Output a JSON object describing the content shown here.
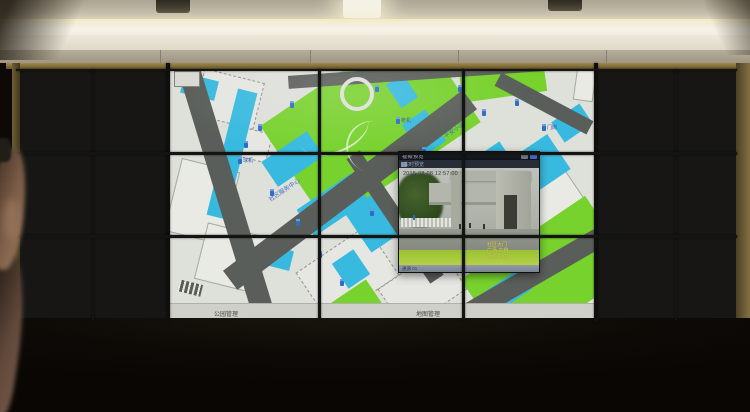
{
  "colors": {
    "map_lawn_green": "#7cdc2f",
    "map_building_cyan": "#39c3eb",
    "map_road_grey": "#5d625e",
    "marker_blue": "#2b72d0",
    "osd_yellow": "#dde437",
    "cove_light": "#fff4cf",
    "frame_gold": "#8a7545"
  },
  "wall": {
    "left_tiles": [
      {
        "scene": "lawn-building",
        "ts": "08-08 12:57",
        "ts_pos": "top"
      },
      {
        "scene": "trees-dense"
      },
      {
        "scene": "trees-dense",
        "ts": "08-08 12:57",
        "ts_pos": "top"
      },
      {
        "scene": "blue-roof"
      },
      {
        "scene": "courtyard"
      },
      {
        "scene": "tree-closeup"
      },
      {
        "scene": "dark-garage"
      },
      {
        "scene": "alley",
        "ts": "08-08 12:57"
      },
      {
        "scene": "garage-car"
      },
      {
        "scene": "alley"
      },
      {
        "scene": "dark-garage",
        "ts": "08-08 12:57"
      },
      {
        "scene": "gate-entry"
      }
    ],
    "right_tiles": [
      {
        "scene": "green-road",
        "ts": "2015-08-08 12:57"
      },
      {
        "scene": "street-dark"
      },
      {
        "scene": "parking-lot"
      },
      {
        "scene": "parking-lot",
        "ts": "08-08 12:57"
      },
      {
        "scene": "street-cars",
        "ts": "08-08 12:57",
        "ts_pos": "top"
      },
      {
        "scene": "street-cars"
      },
      {
        "scene": "cars-row",
        "ts": "08-08 12:57"
      },
      {
        "scene": "tree-closeup"
      },
      {
        "scene": "stairs",
        "ts": "08-08 12:57",
        "ts_pos": "top"
      },
      {
        "scene": "stairs-dark",
        "ts": "08-08 12:57"
      },
      {
        "scene": "alley-light"
      },
      {
        "scene": "courtyard"
      }
    ]
  },
  "map": {
    "toolbar_buttons": [
      {
        "name": "layers",
        "icon": "▦"
      },
      {
        "name": "split-view",
        "icon": "◨"
      },
      {
        "name": "locate",
        "icon": "⌖"
      },
      {
        "name": "measure",
        "icon": "▬"
      },
      {
        "name": "windows",
        "icon": "◫"
      },
      {
        "name": "refresh",
        "icon": "⟲"
      }
    ],
    "pan_control_icon": "✛",
    "status_left": "公园管理",
    "status_right": "地图管理",
    "labels": [
      {
        "x": 96,
        "y": 116,
        "t": "社区服务中心"
      },
      {
        "x": 272,
        "y": 56,
        "t": "平安小区"
      },
      {
        "x": 292,
        "y": 152,
        "t": "文化广场"
      }
    ],
    "markers": [
      {
        "x": 120,
        "y": 32
      },
      {
        "x": 88,
        "y": 55
      },
      {
        "x": 74,
        "y": 72
      },
      {
        "x": 68,
        "y": 88,
        "label": "球机"
      },
      {
        "x": 100,
        "y": 120
      },
      {
        "x": 126,
        "y": 150
      },
      {
        "x": 148,
        "y": 182
      },
      {
        "x": 170,
        "y": 210
      },
      {
        "x": 205,
        "y": 16
      },
      {
        "x": 226,
        "y": 48,
        "label": "枪机"
      },
      {
        "x": 252,
        "y": 78
      },
      {
        "x": 268,
        "y": 98
      },
      {
        "x": 288,
        "y": 16
      },
      {
        "x": 312,
        "y": 40
      },
      {
        "x": 345,
        "y": 30
      },
      {
        "x": 372,
        "y": 55,
        "label": "门岗"
      },
      {
        "x": 330,
        "y": 125
      },
      {
        "x": 300,
        "y": 170
      },
      {
        "x": 200,
        "y": 140
      },
      {
        "x": 240,
        "y": 120
      }
    ],
    "shapes": [
      {
        "k": "bldg",
        "x": 2,
        "y": 95,
        "w": 60,
        "h": 75,
        "r": 14
      },
      {
        "k": "bldg",
        "x": 30,
        "y": 160,
        "w": 62,
        "h": 58,
        "r": 14
      },
      {
        "k": "bldg",
        "x": 355,
        "y": 110,
        "w": 68,
        "h": 85,
        "r": -34
      },
      {
        "k": "bldg",
        "x": 390,
        "y": 185,
        "w": 60,
        "h": 55,
        "r": -34
      },
      {
        "k": "bldg",
        "x": 405,
        "y": -2,
        "w": 20,
        "h": 34,
        "r": 8
      },
      {
        "k": "outline",
        "x": 135,
        "y": 175,
        "w": 85,
        "h": 60,
        "r": -34
      },
      {
        "k": "outline",
        "x": 215,
        "y": 195,
        "w": 75,
        "h": 50,
        "r": -34
      },
      {
        "k": "outline",
        "x": 28,
        "y": 6,
        "w": 62,
        "h": 48,
        "r": 14
      },
      {
        "k": "outline",
        "x": 250,
        "y": 148,
        "w": 45,
        "h": 35,
        "r": -34
      },
      {
        "k": "outline",
        "x": 60,
        "y": 60,
        "w": 40,
        "h": 30,
        "r": 14
      },
      {
        "k": "lawn",
        "x": 108,
        "y": -5,
        "w": 185,
        "h": 120,
        "r": -34
      },
      {
        "k": "lawn",
        "x": 290,
        "y": -10,
        "w": 85,
        "h": 38,
        "r": -8
      },
      {
        "k": "lawn",
        "x": 235,
        "y": 40,
        "w": 60,
        "h": 35,
        "r": -34
      },
      {
        "k": "lawn",
        "x": 303,
        "y": 161,
        "w": 150,
        "h": 90,
        "r": -34
      },
      {
        "k": "lawn",
        "x": 158,
        "y": 222,
        "w": 50,
        "h": 28,
        "r": -34
      },
      {
        "k": "cyan",
        "x": 52,
        "y": 20,
        "w": 20,
        "h": 130,
        "r": 14
      },
      {
        "k": "cyan",
        "x": 95,
        "y": 75,
        "w": 55,
        "h": 30,
        "r": -34
      },
      {
        "k": "cyan",
        "x": 130,
        "y": 120,
        "w": 65,
        "h": 32,
        "r": -34
      },
      {
        "k": "cyan",
        "x": 185,
        "y": 130,
        "w": 35,
        "h": 48,
        "r": -34
      },
      {
        "k": "cyan",
        "x": 240,
        "y": 45,
        "w": 28,
        "h": 38,
        "r": -34
      },
      {
        "k": "cyan",
        "x": 288,
        "y": 85,
        "w": 55,
        "h": 32,
        "r": -34
      },
      {
        "k": "cyan",
        "x": 345,
        "y": 75,
        "w": 48,
        "h": 42,
        "r": -34
      },
      {
        "k": "cyan",
        "x": 385,
        "y": 42,
        "w": 34,
        "h": 24,
        "r": -34
      },
      {
        "k": "cyan",
        "x": 315,
        "y": 210,
        "w": 45,
        "h": 24,
        "r": -34
      },
      {
        "k": "cyan",
        "x": 88,
        "y": 178,
        "w": 34,
        "h": 20,
        "r": 14
      },
      {
        "k": "cyan",
        "x": 222,
        "y": 8,
        "w": 20,
        "h": 28,
        "r": -34
      },
      {
        "k": "cyan",
        "x": 12,
        "y": 8,
        "w": 35,
        "h": 20,
        "r": 14
      },
      {
        "k": "cyan",
        "x": 168,
        "y": 185,
        "w": 26,
        "h": 30,
        "r": -34
      },
      {
        "k": "road",
        "x": -74,
        "y": 114,
        "w": 262,
        "h": 22,
        "r": 73
      },
      {
        "k": "road",
        "x": 30,
        "y": 109,
        "w": 300,
        "h": 24,
        "r": -37
      },
      {
        "k": "road",
        "x": 118,
        "y": -4,
        "w": 312,
        "h": 13,
        "r": -4
      },
      {
        "k": "road",
        "x": 279,
        "y": 199,
        "w": 160,
        "h": 20,
        "r": -30
      },
      {
        "k": "road",
        "x": 322,
        "y": 27,
        "w": 104,
        "h": 15,
        "r": 28
      },
      {
        "k": "road",
        "x": 150,
        "y": 140,
        "w": 150,
        "h": 16,
        "r": 56
      }
    ]
  },
  "popup": {
    "title": "视频预览",
    "toolbar_label": "实时预览",
    "timestamp": "2015-08-08 12:57:00",
    "osd_lines": [
      "社区大门",
      "广场 东侧",
      "摄像机 01"
    ],
    "bottom_text": "通道 01"
  }
}
